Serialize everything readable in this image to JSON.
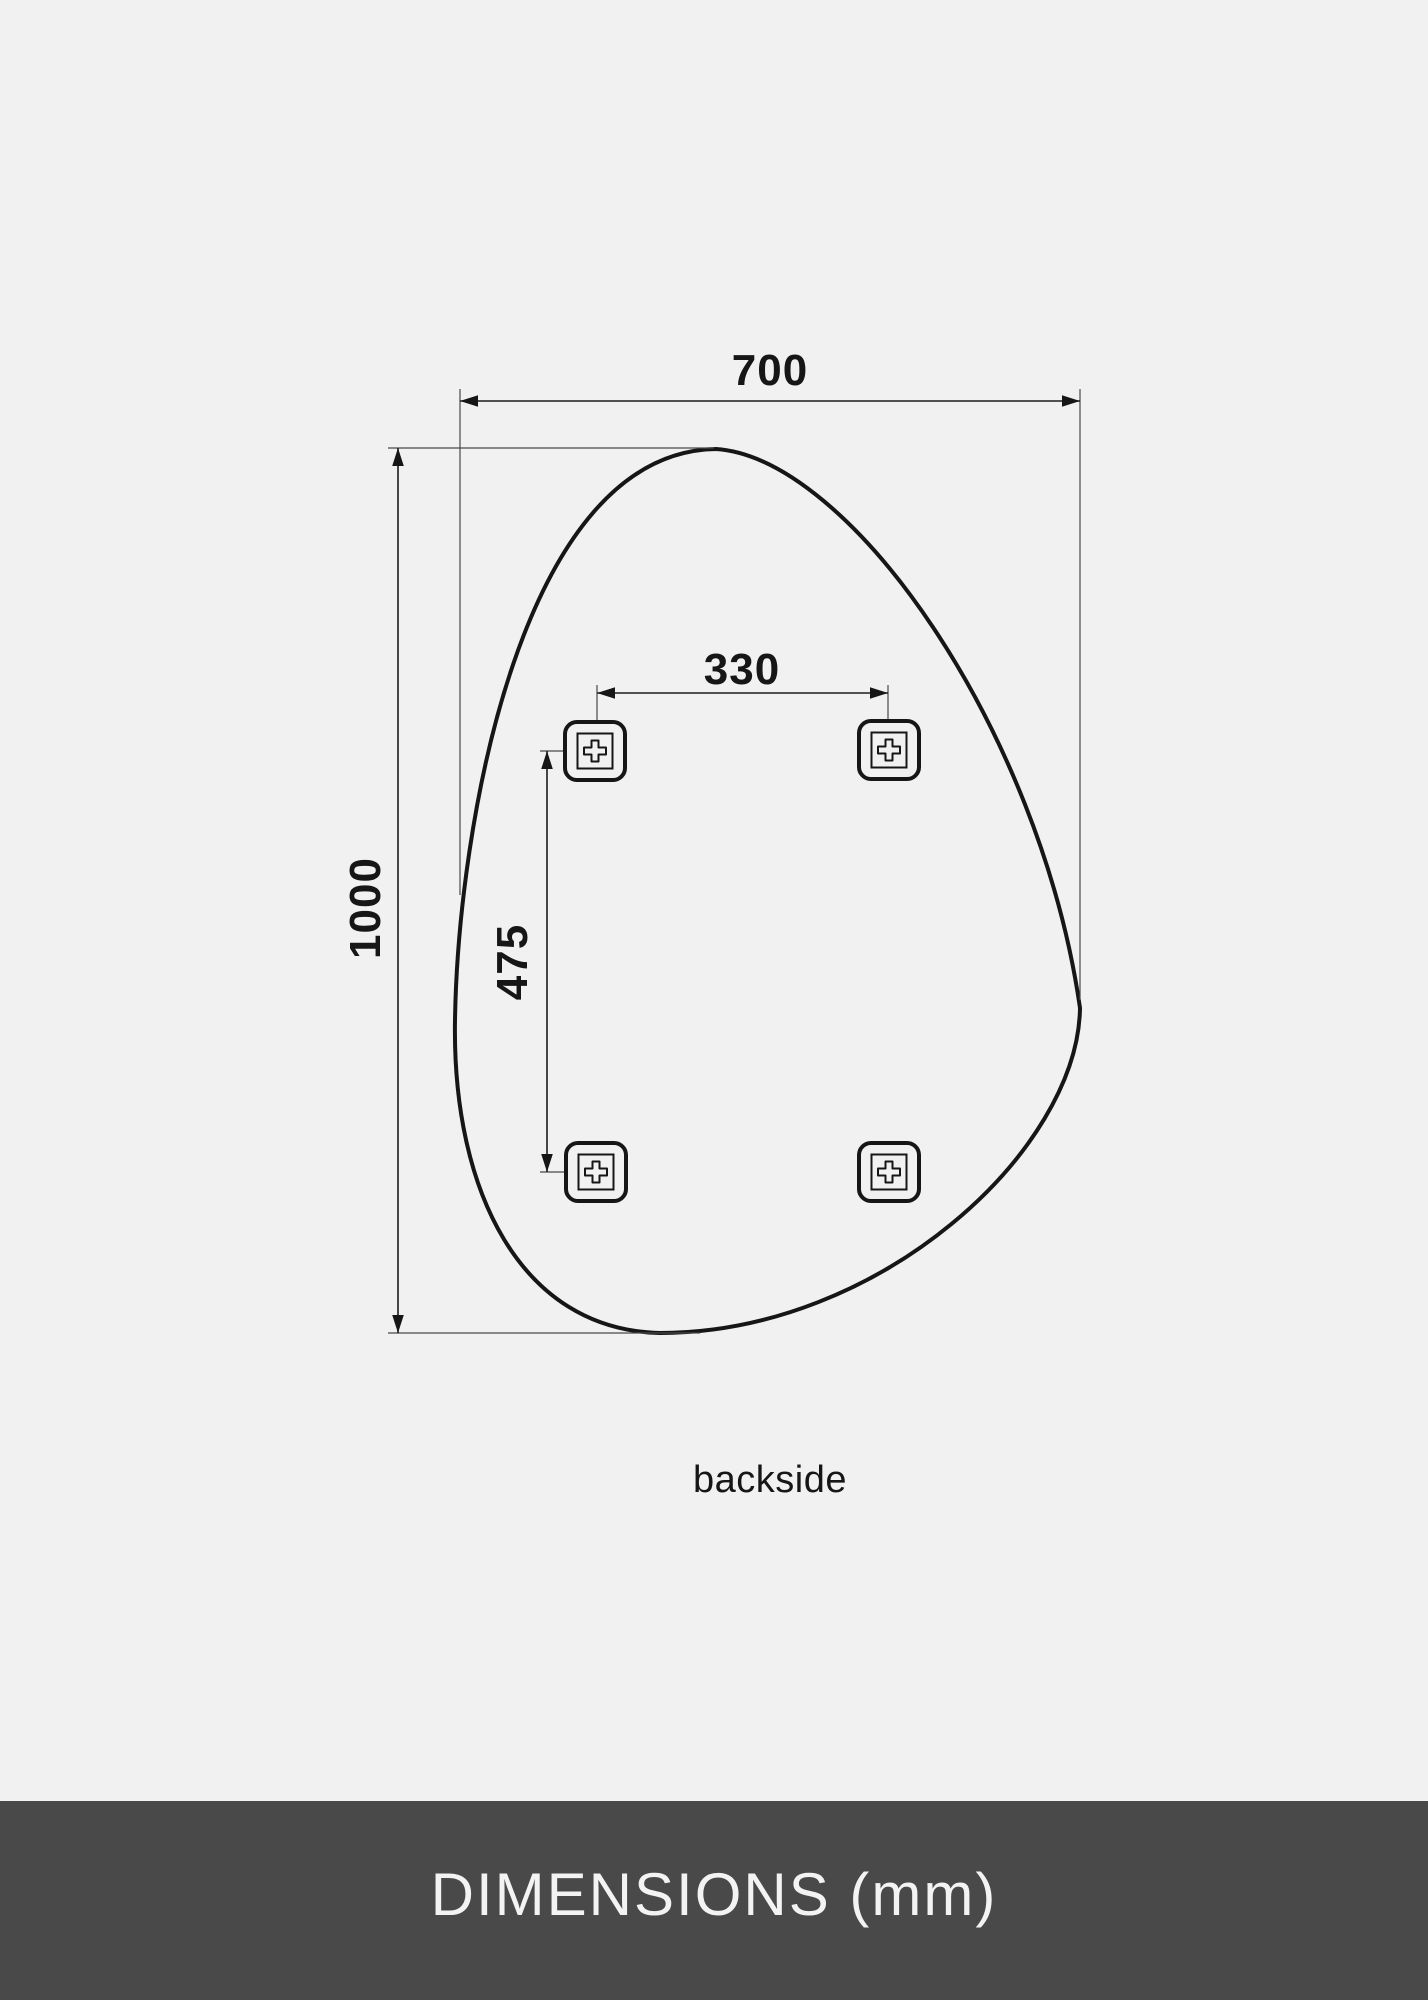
{
  "colors": {
    "background": "#f1f1f2",
    "line": "#161616",
    "footer_background": "#494949",
    "footer_text": "#f3f3f3"
  },
  "diagram": {
    "caption": "backside",
    "labels": {
      "overall_width": "700",
      "overall_height": "1000",
      "bracket_spacing_horizontal": "330",
      "bracket_spacing_vertical": "475"
    }
  },
  "footer": {
    "title": "DIMENSIONS (mm)"
  }
}
